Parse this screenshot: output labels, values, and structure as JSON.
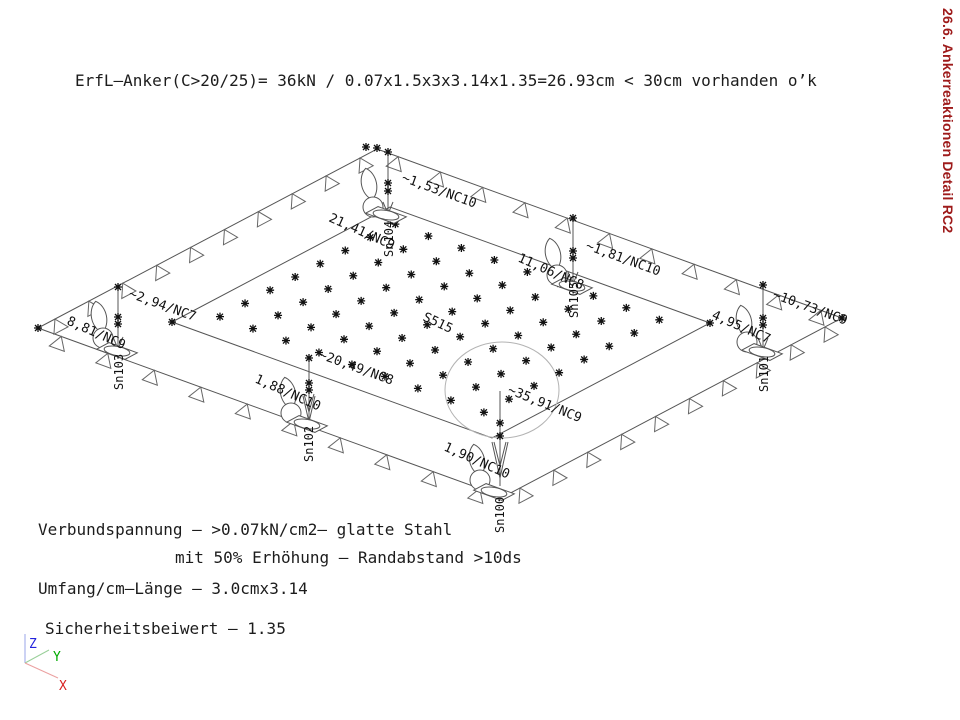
{
  "header": {
    "formula_line": "ErfL—Anker(C>20/25)= 36kN / 0.07x1.5x3x3.14x1.35=26.93cm < 30cm vorhanden o’k"
  },
  "side_title": {
    "text": "26.6. Ankerreaktionen Detail RC2",
    "color": "#9e1b1b"
  },
  "notes": {
    "line1": "Verbundspannung — >0.07kN/cm2— glatte Stahl",
    "line2": "mit 50% Erhöhung — Randabstand >10ds",
    "line3": "Umfang/cm—Länge — 3.0cmx3.14",
    "line4": "Sicherheitsbeiwert — 1.35"
  },
  "axes": {
    "x_label": "X",
    "y_label": "Y",
    "z_label": "Z",
    "x_color": "#d82222",
    "y_color": "#00aa00",
    "z_color": "#2222dd"
  },
  "diagram": {
    "slab_label": "S515",
    "anchors": [
      {
        "id": "Sn104",
        "value_top": "~1,53/NC10",
        "value_side": "21,41/NC9"
      },
      {
        "id": "Sn105",
        "value_top": "~1,81/NC10",
        "value_side": "11,06/NC8"
      },
      {
        "id": "Sn101",
        "value_top": "~10,73/NC9",
        "value_side": "4,95/NC7"
      },
      {
        "id": "Sn103",
        "value_top": "~2,94/NC7",
        "value_side": "8,81/NC9"
      },
      {
        "id": "Sn102",
        "value_top": "~20,49/NC8",
        "value_side": "1,88/NC10"
      },
      {
        "id": "Sn100",
        "value_top": "~35,91/NC9",
        "value_side": "1,90/NC10"
      }
    ]
  }
}
